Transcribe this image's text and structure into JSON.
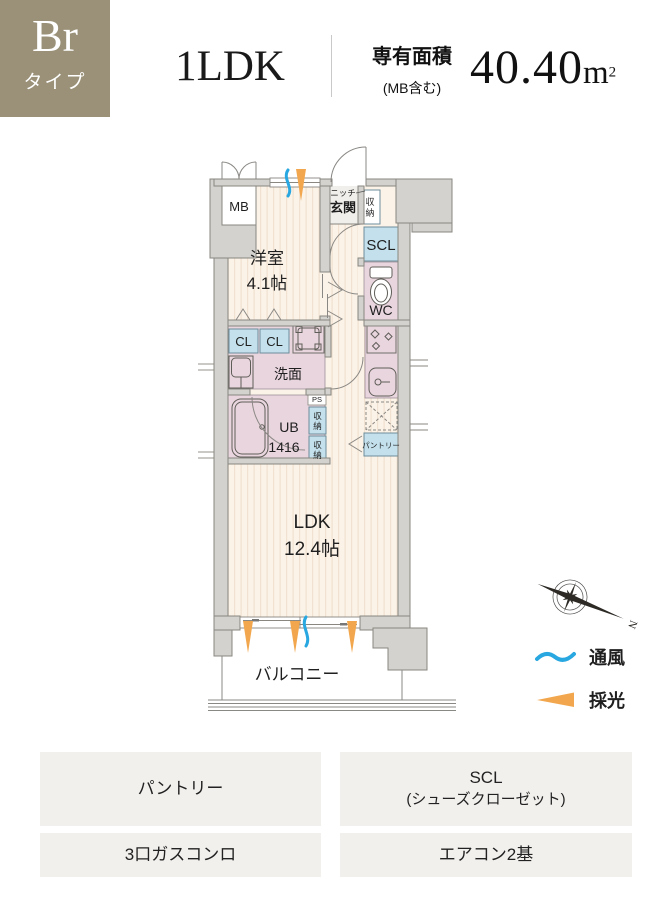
{
  "header": {
    "type_code": "Br",
    "type_suffix": "タイプ",
    "layout": "1LDK",
    "area_title": "専有面積",
    "area_note": "(MB含む)",
    "area_number": "40.40",
    "area_unit": "m",
    "area_exponent": "2"
  },
  "plan": {
    "labels": {
      "mb": "MB",
      "niche": "ニッチ",
      "entrance": "玄関",
      "storage_chars": [
        "収",
        "納"
      ],
      "scl": "SCL",
      "wc": "WC",
      "western_name": "洋室",
      "western_size": "4.1帖",
      "cl": "CL",
      "washroom": "洗面",
      "ub": "UB",
      "ub_size": "1416",
      "ps": "PS",
      "pantry": "パントリー",
      "ldk_name": "LDK",
      "ldk_size": "12.4帖",
      "balcony": "バルコニー",
      "north": "N"
    },
    "legend": {
      "ventilation": "通風",
      "daylight": "採光"
    }
  },
  "features": {
    "pantry": "パントリー",
    "scl_line1": "SCL",
    "scl_line2": "(シューズクローゼット)",
    "stove": "3口ガスコンロ",
    "aircon": "エアコン2基"
  },
  "colors": {
    "badge_olive": "#9a9178",
    "wall_fill": "#d4d2ce",
    "wall_line": "#898780",
    "floor_cream": "#fcf3e8",
    "floor_stripe": "#f0e1d0",
    "wet_area_pink": "#e9d5de",
    "closet_blue": "#c3e0ec",
    "ventilation_blue": "#29a7e0",
    "daylight_orange": "#f2a74e",
    "footer_gray": "#f2f0ed"
  }
}
